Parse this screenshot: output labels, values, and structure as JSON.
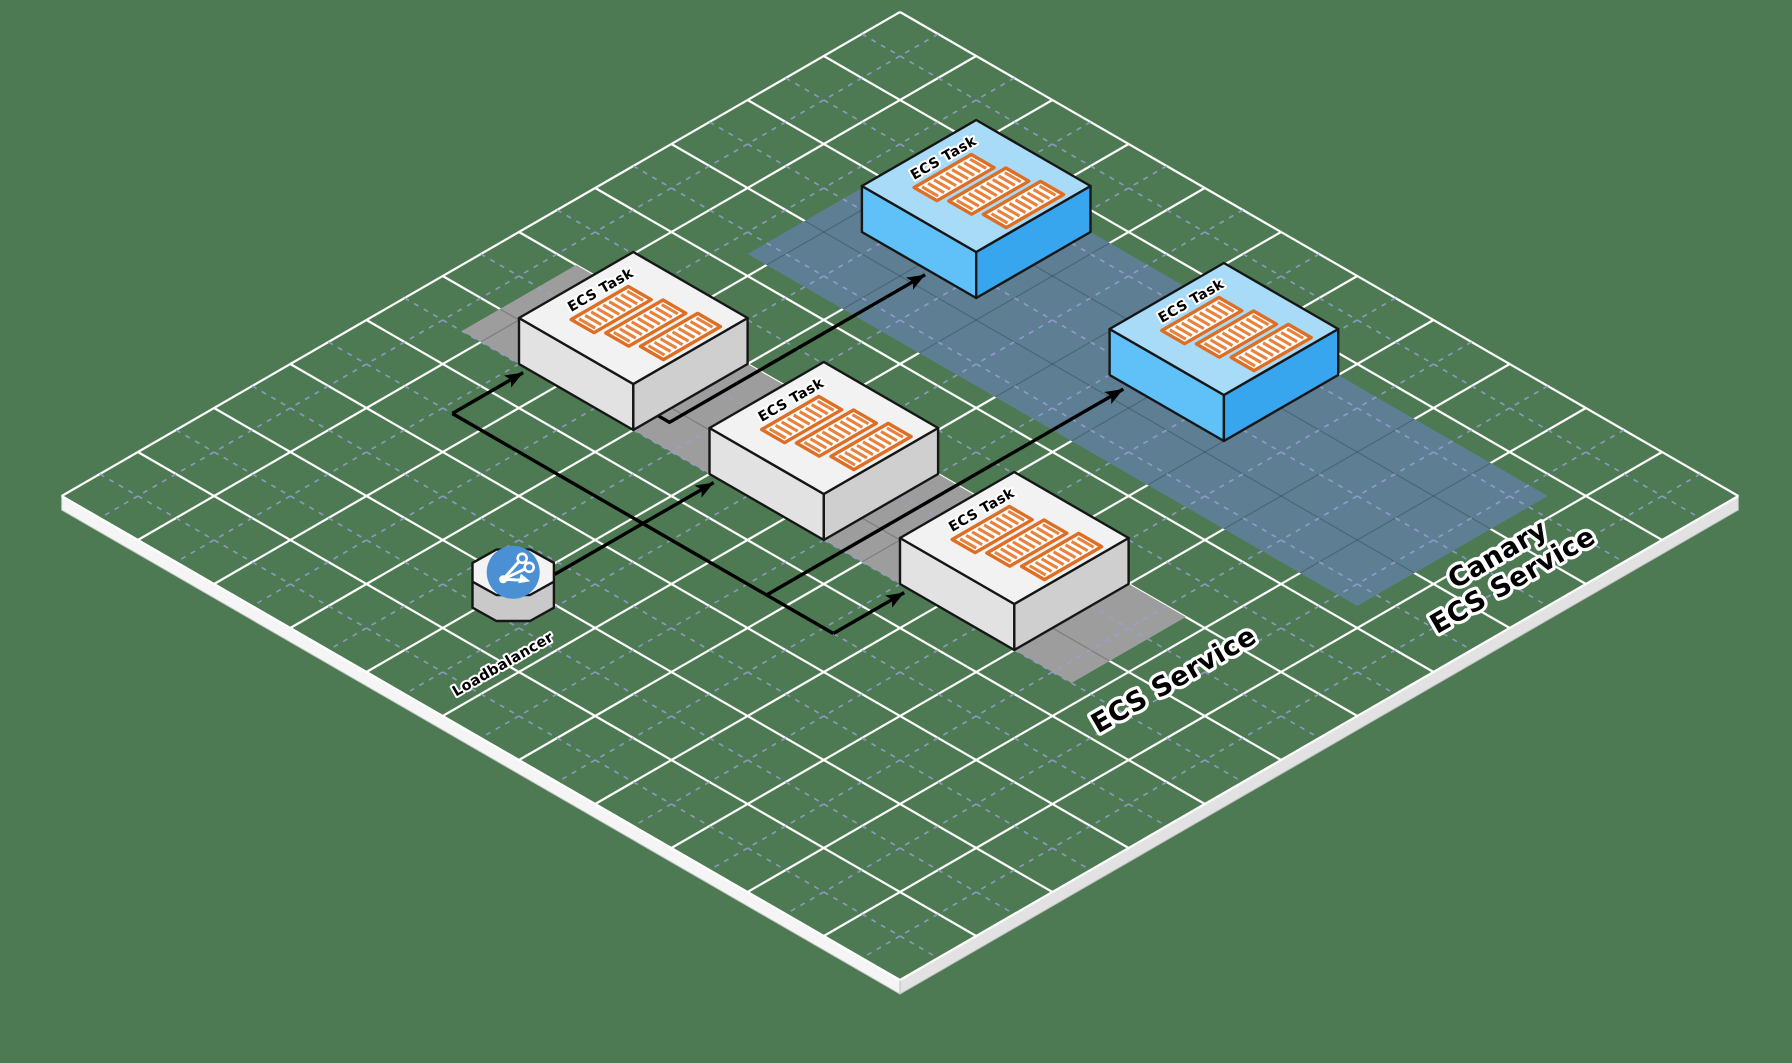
{
  "diagram": {
    "type": "isometric-architecture",
    "background_color": "#4d7a52",
    "grid": {
      "major_line_color": "#ffffff",
      "dashed_line_color": "#9aa0d8"
    },
    "plane_edge_colors": {
      "southwest": "#f5f5f5",
      "southeast": "#e2e2e2"
    },
    "services": [
      {
        "id": "ecs-service",
        "label_lines": [
          "ECS Service"
        ],
        "band_color": "#9d9d9d"
      },
      {
        "id": "canary-ecs-service",
        "label_lines": [
          "Canary",
          "ECS Service"
        ],
        "band_color": "#5e7f93"
      }
    ],
    "tasks": [
      {
        "id": "task-1",
        "label": "ECS Task",
        "service": "ecs-service"
      },
      {
        "id": "task-2",
        "label": "ECS Task",
        "service": "ecs-service"
      },
      {
        "id": "task-3",
        "label": "ECS Task",
        "service": "ecs-service"
      },
      {
        "id": "task-4",
        "label": "ECS Task",
        "service": "canary-ecs-service"
      },
      {
        "id": "task-5",
        "label": "ECS Task",
        "service": "canary-ecs-service"
      }
    ],
    "task_styles": {
      "standard": {
        "top": "#f2f2f2",
        "left": "#e2e2e2",
        "right": "#cfcfcf"
      },
      "canary": {
        "top": "#a8dbf8",
        "left": "#60c1f8",
        "right": "#38a6ee"
      }
    },
    "container_style": {
      "fill": "#ffffff",
      "stripe_color": "#e8823c",
      "border_color": "#dd6e24"
    },
    "loadbalancer": {
      "id": "loadbalancer",
      "label": "Loadbalancer",
      "icon": "load-balancer-icon",
      "icon_color": "#4a90d2"
    },
    "connections": [
      {
        "from": "loadbalancer",
        "to": "task-1"
      },
      {
        "from": "loadbalancer",
        "to": "task-2"
      },
      {
        "from": "loadbalancer",
        "to": "task-3"
      },
      {
        "from": "loadbalancer",
        "to": "task-4"
      },
      {
        "from": "loadbalancer",
        "to": "task-5"
      }
    ],
    "arrow_color": "#000000"
  }
}
